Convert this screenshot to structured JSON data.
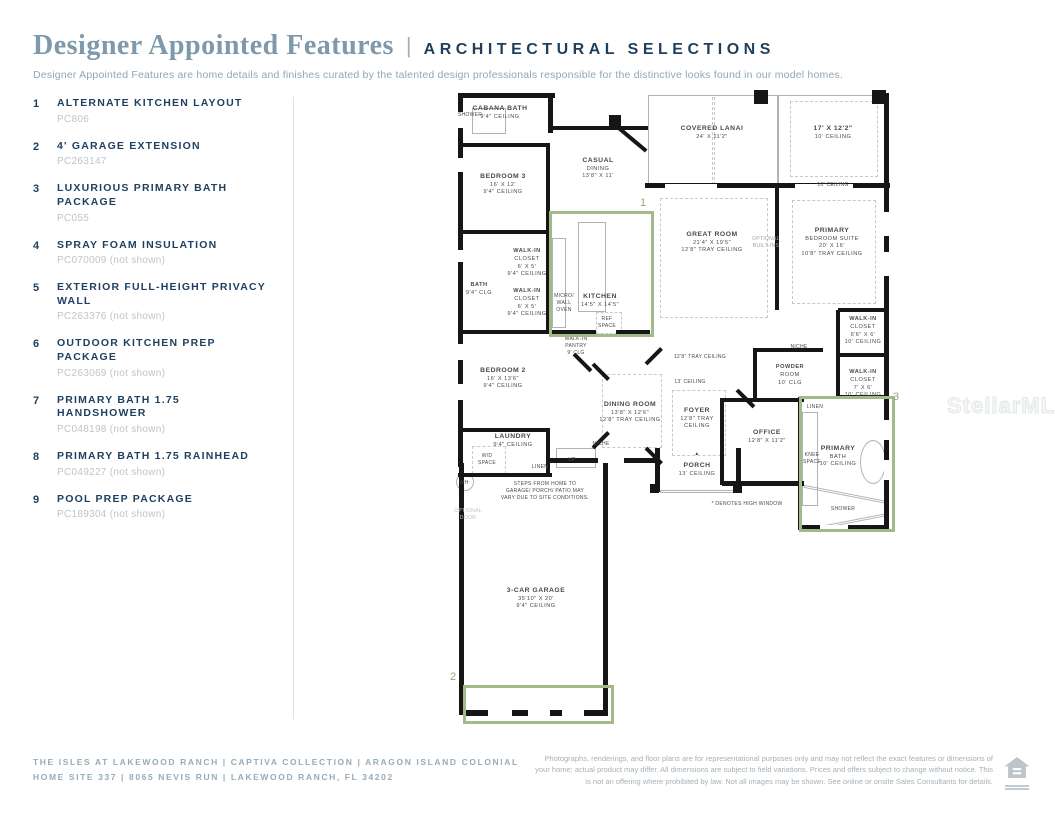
{
  "header": {
    "title_serif": "Designer Appointed Features",
    "divider": "|",
    "title_caps": "ARCHITECTURAL SELECTIONS",
    "subtitle": "Designer Appointed Features are home details and finishes curated by the talented design professionals responsible for the distinctive looks found in our model homes."
  },
  "features": [
    {
      "num": "1",
      "title": "ALTERNATE KITCHEN LAYOUT",
      "code": "PC806"
    },
    {
      "num": "2",
      "title": "4' GARAGE EXTENSION",
      "code": "PC263147"
    },
    {
      "num": "3",
      "title": "LUXURIOUS PRIMARY BATH PACKAGE",
      "code": "PC055"
    },
    {
      "num": "4",
      "title": "SPRAY FOAM INSULATION",
      "code": "PC070009 (not shown)"
    },
    {
      "num": "5",
      "title": "EXTERIOR FULL-HEIGHT PRIVACY WALL",
      "code": "PC263376 (not shown)"
    },
    {
      "num": "6",
      "title": "OUTDOOR KITCHEN PREP PACKAGE",
      "code": "PC263069 (not shown)"
    },
    {
      "num": "7",
      "title": "PRIMARY BATH 1.75 HANDSHOWER",
      "code": "PC048198 (not shown)"
    },
    {
      "num": "8",
      "title": "PRIMARY BATH 1.75 RAINHEAD",
      "code": "PC049227 (not shown)"
    },
    {
      "num": "9",
      "title": "POOL PREP PACKAGE",
      "code": "PC189304 (not shown)"
    }
  ],
  "floorplan": {
    "watermark": "StellarMLS",
    "highlights": [
      {
        "num": "1",
        "x": 549,
        "y": 211,
        "w": 99,
        "h": 120,
        "nx": 640,
        "ny": 197
      },
      {
        "num": "2",
        "x": 463,
        "y": 685,
        "w": 145,
        "h": 33,
        "nx": 450,
        "ny": 671
      },
      {
        "num": "3",
        "x": 799,
        "y": 396,
        "w": 90,
        "h": 130,
        "nx": 893,
        "ny": 391
      }
    ],
    "labels": [
      {
        "x": 500,
        "y": 104,
        "s": "md",
        "lines": [
          "CABANA BATH",
          "9'4\" CEILING"
        ]
      },
      {
        "x": 470,
        "y": 112,
        "s": "xs",
        "lines": [
          "SHOWER"
        ]
      },
      {
        "x": 503,
        "y": 172,
        "s": "md",
        "lines": [
          "BEDROOM 3",
          "16' X 12'",
          "9'4\" CEILING"
        ]
      },
      {
        "x": 598,
        "y": 156,
        "s": "md",
        "lines": [
          "CASUAL",
          "DINING",
          "13'8\" X 11'"
        ]
      },
      {
        "x": 712,
        "y": 124,
        "s": "md",
        "lines": [
          "COVERED LANAI",
          "24' X 11'2\""
        ]
      },
      {
        "x": 833,
        "y": 124,
        "s": "md",
        "lines": [
          "17' X 12'2\"",
          "10' CEILING"
        ]
      },
      {
        "x": 833,
        "y": 182,
        "s": "xs",
        "lines": [
          "10' CEILING"
        ]
      },
      {
        "x": 712,
        "y": 230,
        "s": "md",
        "lines": [
          "GREAT ROOM",
          "21'4\" X 19'5\"",
          "12'8\" TRAY CEILING"
        ]
      },
      {
        "x": 766,
        "y": 236,
        "s": "xs",
        "c": "#9aa0a4",
        "lines": [
          "OPTIONAL",
          "BUILT-INS"
        ]
      },
      {
        "x": 832,
        "y": 226,
        "s": "md",
        "lines": [
          "PRIMARY",
          "BEDROOM SUITE",
          "20' X 16'",
          "10'8\" TRAY CEILING"
        ]
      },
      {
        "x": 527,
        "y": 248,
        "s": "sm",
        "lines": [
          "WALK-IN",
          "CLOSET",
          "6' X 5'",
          "9'4\" CEILING"
        ]
      },
      {
        "x": 479,
        "y": 282,
        "s": "sm",
        "lines": [
          "BATH",
          "9'4\" CLG"
        ]
      },
      {
        "x": 527,
        "y": 288,
        "s": "sm",
        "lines": [
          "WALK-IN",
          "CLOSET",
          "6' X 5'",
          "9'4\" CEILING"
        ]
      },
      {
        "x": 564,
        "y": 293,
        "s": "xs",
        "lines": [
          "MICRO/",
          "WALL",
          "OVEN"
        ]
      },
      {
        "x": 600,
        "y": 292,
        "s": "md",
        "lines": [
          "KITCHEN",
          "14'5\" X 14'5\""
        ]
      },
      {
        "x": 607,
        "y": 316,
        "s": "xs",
        "lines": [
          "REF",
          "SPACE"
        ]
      },
      {
        "x": 576,
        "y": 336,
        "s": "xs",
        "lines": [
          "WALK-IN",
          "PANTRY",
          "9' CLG"
        ]
      },
      {
        "x": 700,
        "y": 354,
        "s": "xs",
        "lines": [
          "12'8\" TRAY CEILING"
        ]
      },
      {
        "x": 690,
        "y": 379,
        "s": "xs",
        "lines": [
          "13' CEILING"
        ]
      },
      {
        "x": 503,
        "y": 366,
        "s": "md",
        "lines": [
          "BEDROOM 2",
          "16' X 13'6\"",
          "9'4\" CEILING"
        ]
      },
      {
        "x": 630,
        "y": 400,
        "s": "md",
        "lines": [
          "DINING ROOM",
          "13'8\" X 12'6\"",
          "12'8\" TRAY CEILING"
        ]
      },
      {
        "x": 601,
        "y": 441,
        "s": "xs",
        "lines": [
          "NICHE"
        ]
      },
      {
        "x": 697,
        "y": 406,
        "s": "md",
        "lines": [
          "FOYER",
          "12'8\" TRAY",
          "CEILING"
        ]
      },
      {
        "x": 790,
        "y": 364,
        "s": "sm",
        "lines": [
          "POWDER",
          "ROOM",
          "10' CLG"
        ]
      },
      {
        "x": 799,
        "y": 344,
        "s": "xs",
        "lines": [
          "NICHE"
        ]
      },
      {
        "x": 767,
        "y": 428,
        "s": "md",
        "lines": [
          "OFFICE",
          "12'8\" X 11'2\""
        ]
      },
      {
        "x": 697,
        "y": 451,
        "s": "xs",
        "lines": [
          "▲"
        ]
      },
      {
        "x": 697,
        "y": 461,
        "s": "md",
        "lines": [
          "PORCH",
          "13' CEILING"
        ]
      },
      {
        "x": 863,
        "y": 316,
        "s": "sm",
        "lines": [
          "WALK-IN",
          "CLOSET",
          "6'6\" X 6'",
          "10' CEILING"
        ]
      },
      {
        "x": 863,
        "y": 369,
        "s": "sm",
        "lines": [
          "WALK-IN",
          "CLOSET",
          "7' X 6'",
          "10' CEILING"
        ]
      },
      {
        "x": 815,
        "y": 404,
        "s": "xs",
        "lines": [
          "LINEN"
        ]
      },
      {
        "x": 838,
        "y": 444,
        "s": "md",
        "lines": [
          "PRIMARY",
          "BATH",
          "10' CEILING"
        ]
      },
      {
        "x": 812,
        "y": 452,
        "s": "xs",
        "lines": [
          "KNEE",
          "SPACE"
        ]
      },
      {
        "x": 843,
        "y": 506,
        "s": "xs",
        "lines": [
          "SHOWER"
        ]
      },
      {
        "x": 513,
        "y": 432,
        "s": "md",
        "lines": [
          "LAUNDRY",
          "9'4\" CEILING"
        ]
      },
      {
        "x": 487,
        "y": 453,
        "s": "xs",
        "lines": [
          "W/D",
          "SPACE"
        ]
      },
      {
        "x": 540,
        "y": 464,
        "s": "xs",
        "lines": [
          "LINEN"
        ]
      },
      {
        "x": 572,
        "y": 457,
        "s": "xs",
        "lines": [
          "UP"
        ]
      },
      {
        "x": 464,
        "y": 480,
        "s": "xs",
        "lines": [
          "WH"
        ]
      },
      {
        "x": 545,
        "y": 481,
        "s": "xs",
        "lines": [
          "STEPS FROM HOME TO",
          "GARAGE/ PORCH/ PATIO MAY",
          "VARY DUE TO SITE CONDITIONS."
        ]
      },
      {
        "x": 468,
        "y": 508,
        "s": "xs",
        "c": "#bcc2c6",
        "lines": [
          "OPTIONAL",
          "DOOR"
        ]
      },
      {
        "x": 536,
        "y": 586,
        "s": "md",
        "lines": [
          "3-CAR GARAGE",
          "35'10\" X 20'",
          "9'4\" CEILING"
        ]
      },
      {
        "x": 747,
        "y": 501,
        "s": "xs",
        "lines": [
          "* DENOTES HIGH WINDOW"
        ]
      }
    ]
  },
  "footer": {
    "line1": "THE ISLES AT LAKEWOOD RANCH  |  CAPTIVA COLLECTION   |  ARAGON ISLAND COLONIAL",
    "line2": "HOME SITE 337   |   8065 NEVIS RUN  |  LAKEWOOD RANCH, FL 34202",
    "disclaimer": "Photographs, renderings, and floor plans are for representational purposes only and may not reflect the exact features or dimensions of your home; actual product may differ. All dimensions are subject to field variations. Prices and offers subject to change without notice. This is not an offering where prohibited by law. Not all images may be shown. See online or onsite Sales Consultants for details."
  }
}
